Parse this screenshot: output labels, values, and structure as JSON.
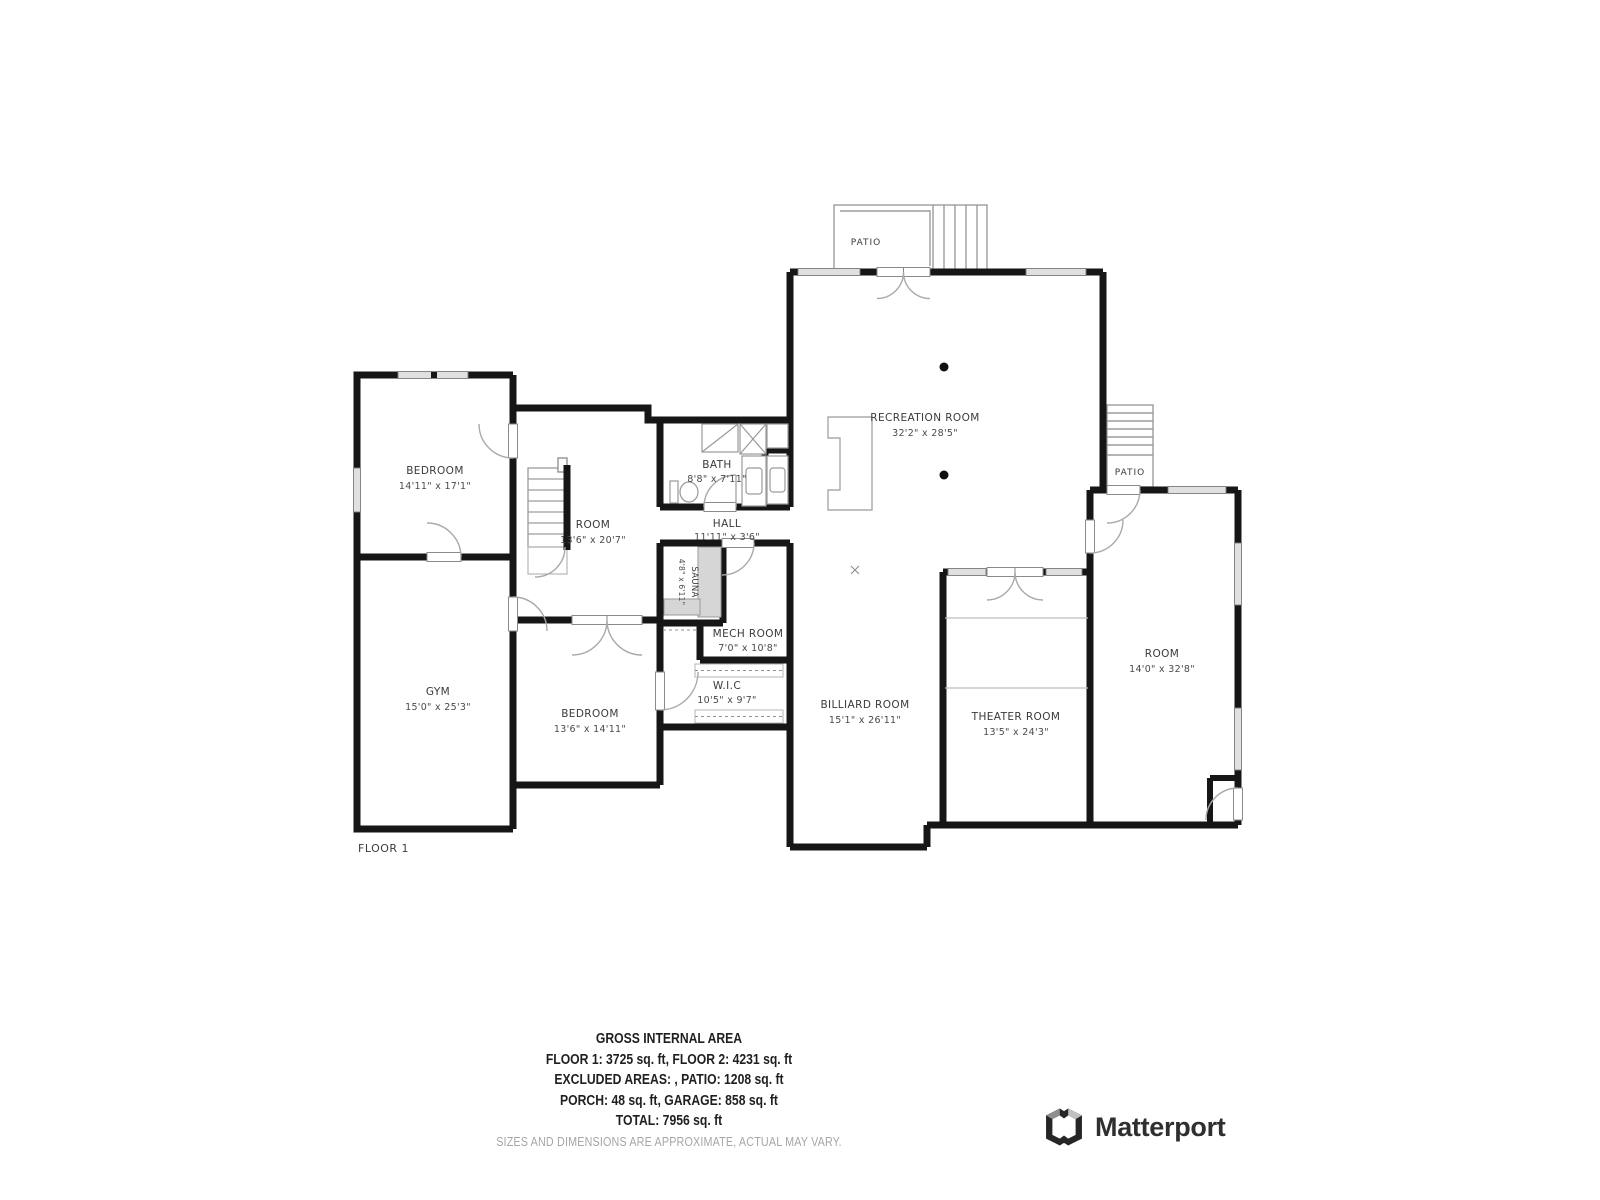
{
  "floor_label": "FLOOR 1",
  "rooms": [
    {
      "name": "PATIO",
      "dims": ""
    },
    {
      "name": "RECREATION ROOM",
      "dims": "32'2\" x 28'5\""
    },
    {
      "name": "BEDROOM",
      "dims": "14'11\" x 17'1\""
    },
    {
      "name": "ROOM",
      "dims": "13'6\" x 20'7\""
    },
    {
      "name": "BATH",
      "dims": "8'8\" x 7'11\""
    },
    {
      "name": "HALL",
      "dims": "11'11\" x 3'6\""
    },
    {
      "name": "PATIO",
      "dims": ""
    },
    {
      "name": "SAUNA",
      "dims": "4'8\" x 6'11\""
    },
    {
      "name": "MECH ROOM",
      "dims": "7'0\" x 10'8\""
    },
    {
      "name": "W.I.C",
      "dims": "10'5\" x 9'7\""
    },
    {
      "name": "GYM",
      "dims": "15'0\" x 25'3\""
    },
    {
      "name": "BEDROOM",
      "dims": "13'6\" x 14'11\""
    },
    {
      "name": "BILLIARD ROOM",
      "dims": "15'1\" x 26'11\""
    },
    {
      "name": "THEATER ROOM",
      "dims": "13'5\" x 24'3\""
    },
    {
      "name": "ROOM",
      "dims": "14'0\" x 32'8\""
    }
  ],
  "footer": {
    "title": "GROSS INTERNAL AREA",
    "line1": "FLOOR 1: 3725 sq. ft, FLOOR 2: 4231 sq. ft",
    "line2": "EXCLUDED AREAS: , PATIO: 1208 sq. ft",
    "line3": "PORCH: 48 sq. ft, GARAGE: 858 sq. ft",
    "line4": "TOTAL: 7956 sq. ft",
    "disclaimer": "SIZES AND DIMENSIONS ARE APPROXIMATE, ACTUAL MAY VARY."
  },
  "brand": {
    "name": "Matterport"
  },
  "colors": {
    "wall": "#161616",
    "label": "#3a3a3a",
    "disclaimer": "#a6a6a6",
    "window": "#e0e0e0"
  }
}
